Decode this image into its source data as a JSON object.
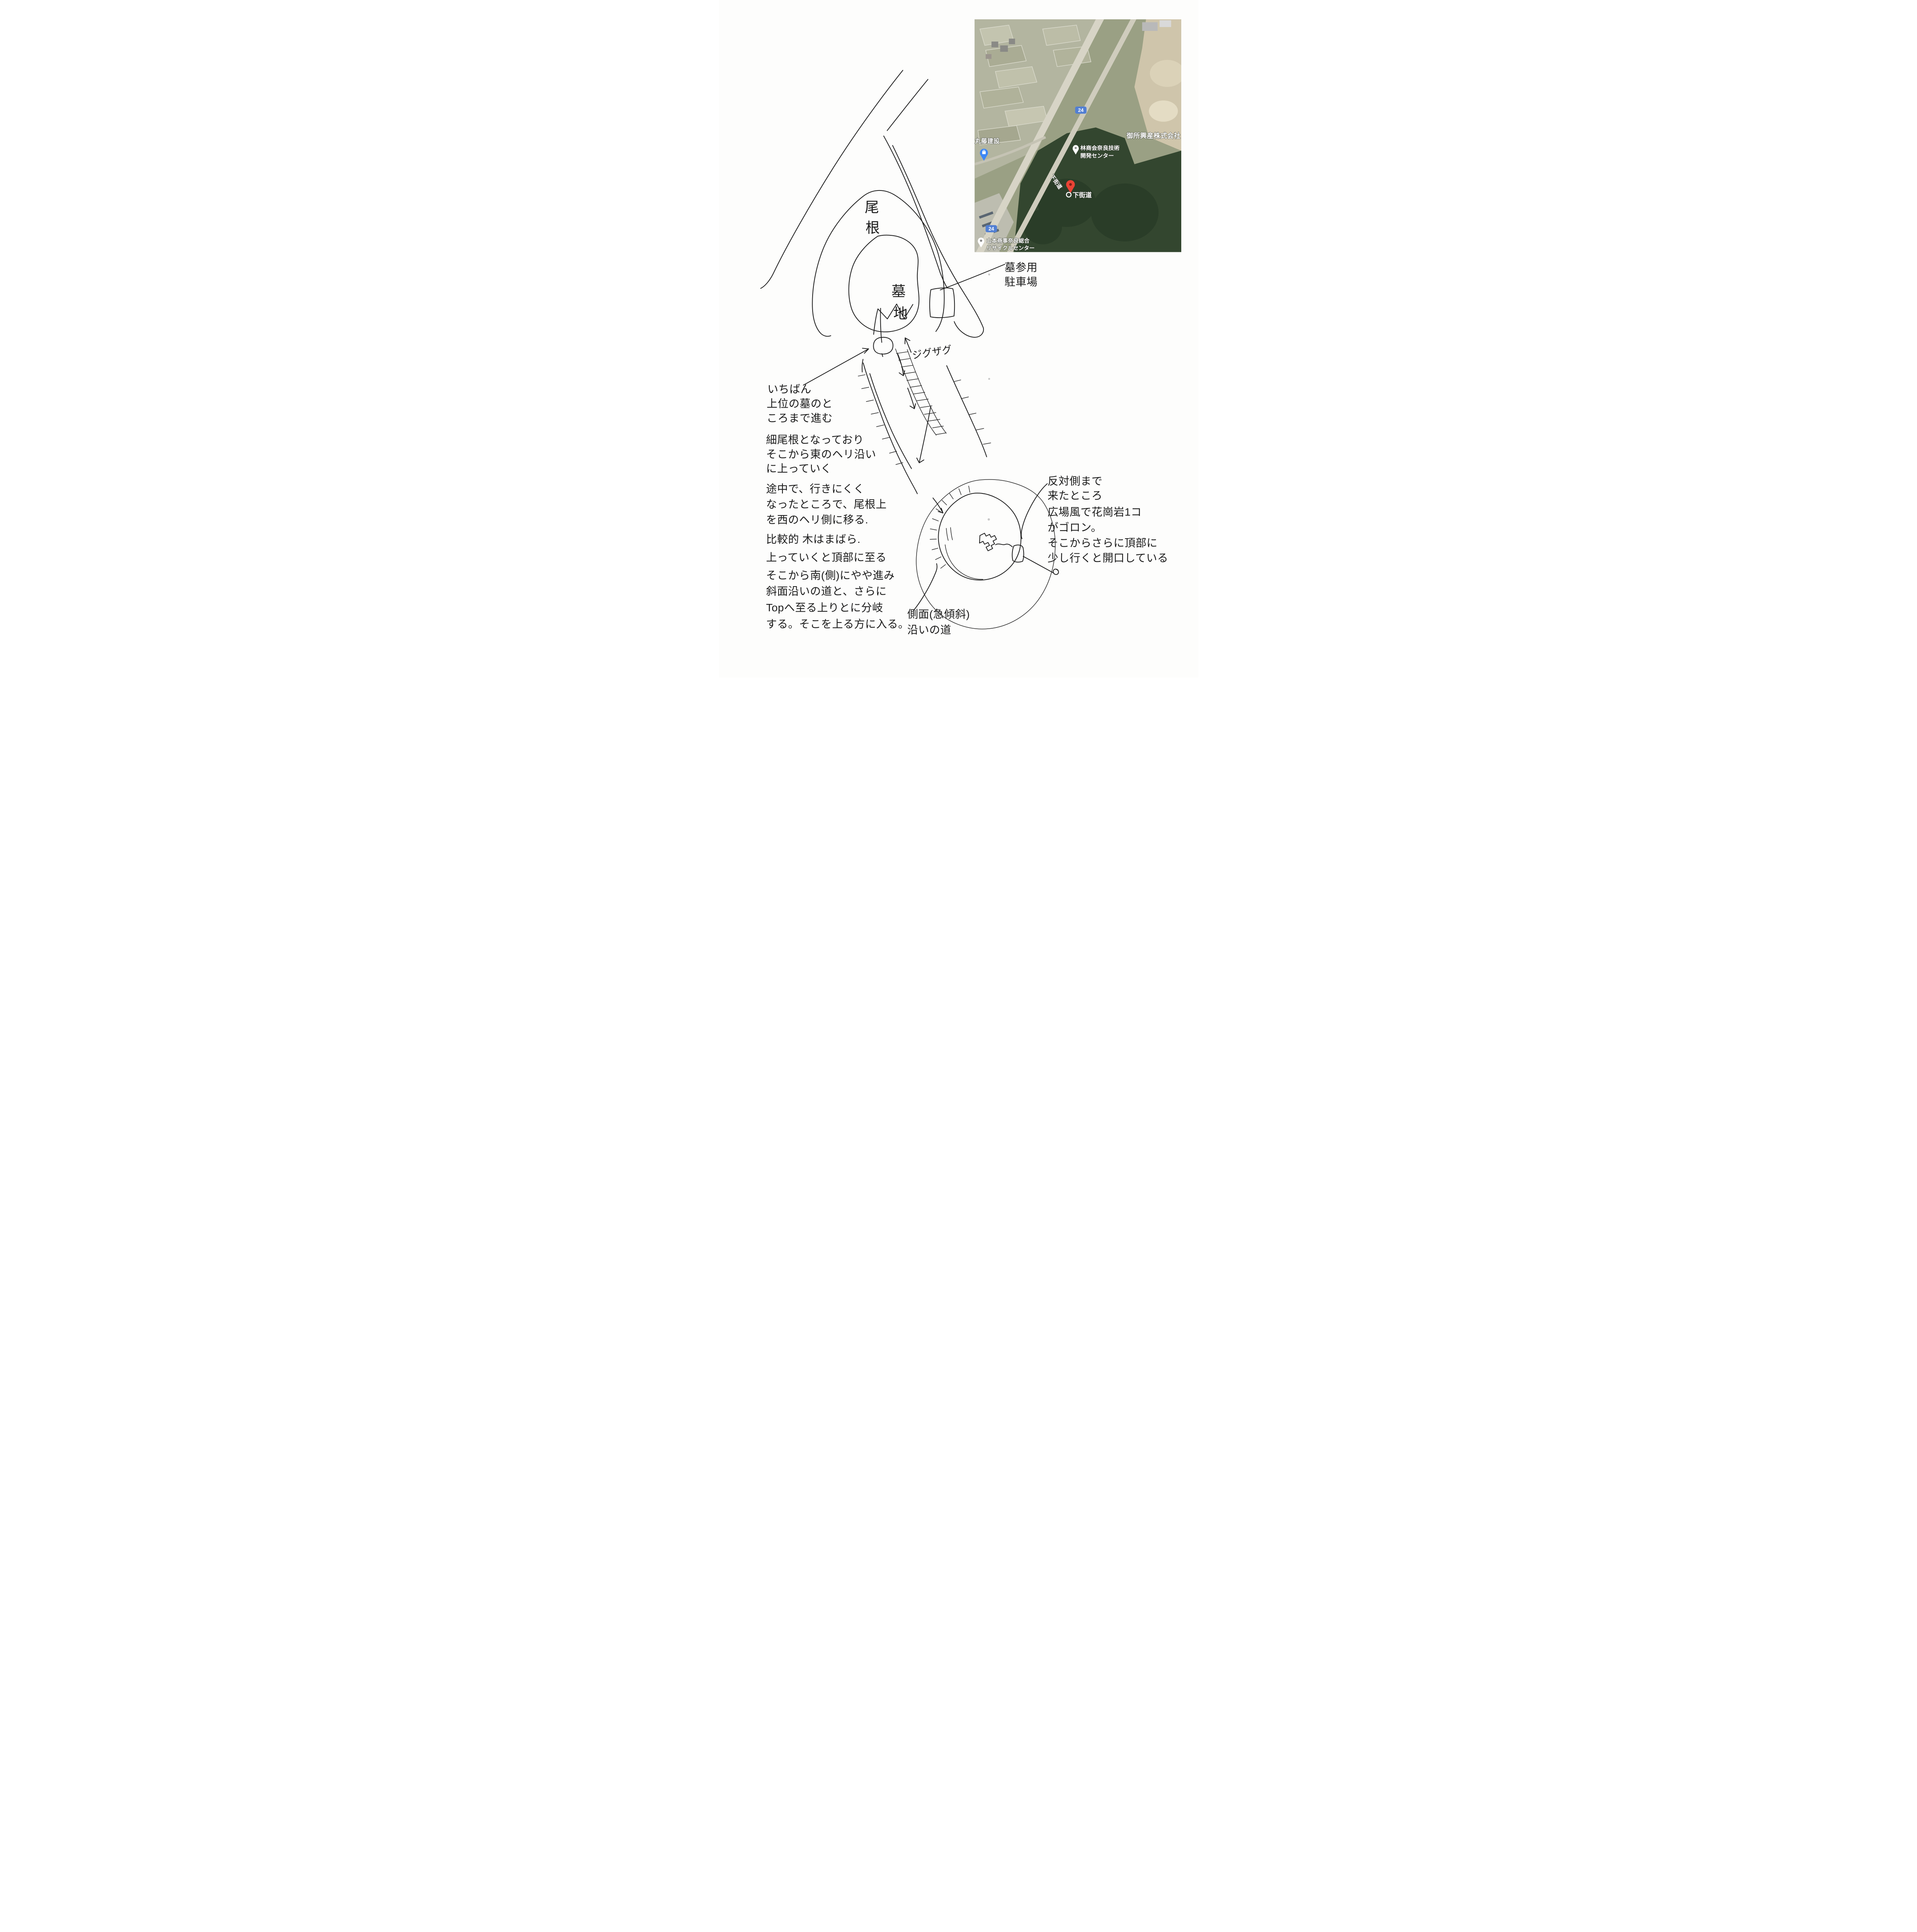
{
  "colors": {
    "paper": "#fdfdfc",
    "ink": "#1f1f1f",
    "pin_red": "#e94335",
    "route_badge_blue": "#527fd3",
    "poi_pin_blue": "#3d87f5",
    "forest_green": "#33462f",
    "field_tan": "#b3b5a0"
  },
  "map": {
    "labels": {
      "construction_company": "丸藤建設",
      "tech_center_line1": "林商会奈良技術",
      "tech_center_line2": "開発センター",
      "industrial_company": "御所興産株式会社",
      "road_name_on_road": "下街道",
      "dropped_pin_label": "下街道",
      "recycle_center_line1": "山本商事奈良総合",
      "recycle_center_line2": "リサイクルセンター",
      "route_number": "24"
    }
  },
  "sketch": {
    "ridge_char1": "尾",
    "ridge_char2": "根",
    "cemetery_char1": "墓",
    "cemetery_char2": "地",
    "parking_line1": "墓参用",
    "parking_line2": "駐車場",
    "zigzag_label": "ジグザグ",
    "side_slope_line1": "側面(急傾斜)",
    "side_slope_line2": "沿いの道",
    "notes_left": [
      [
        "いちばん",
        "上位の墓のと",
        "ころまで進む"
      ],
      [
        "細尾根となっており",
        "そこから東のヘリ沿い",
        "に上っていく"
      ],
      [
        "途中で、行きにくく",
        "なったところで、尾根上",
        "を西のヘリ側に移る."
      ],
      [
        "比較的 木はまばら.",
        "上っていくと頂部に至る"
      ],
      [
        "そこから南(側)にやや進み",
        "斜面沿いの道と、さらに",
        "Topへ至る上りとに分岐",
        "する。そこを上る方に入る。"
      ]
    ],
    "note_right": [
      "反対側まで",
      "来たところ",
      "広場風で花崗岩1コ",
      "がゴロン。",
      "そこからさらに頂部に",
      "少し行くと開口している"
    ]
  }
}
